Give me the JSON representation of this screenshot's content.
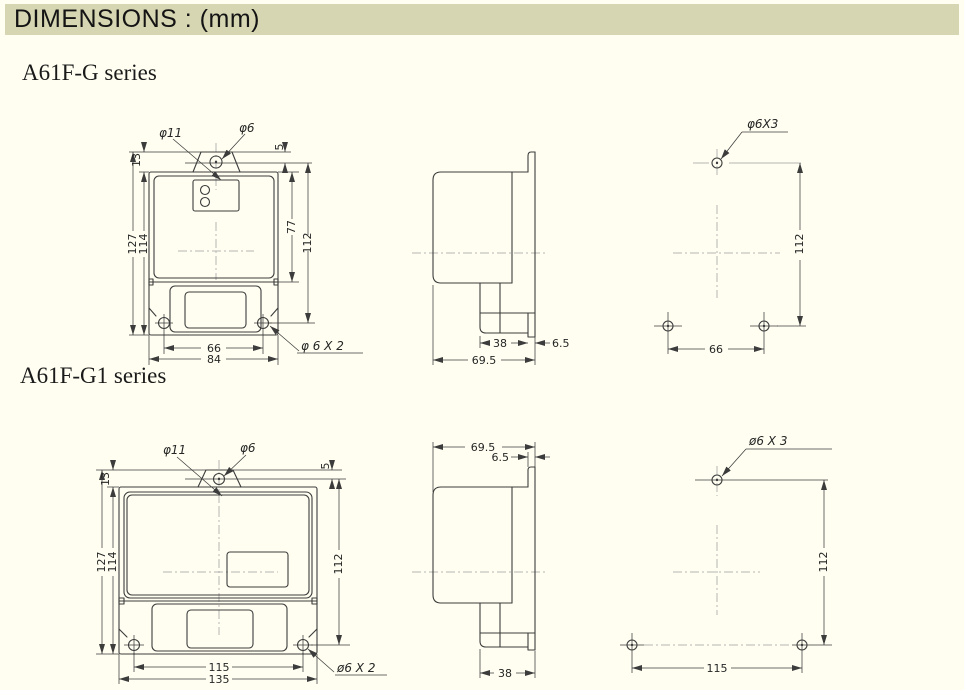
{
  "header": {
    "title": "DIMENSIONS : (mm)"
  },
  "colors": {
    "header_bg": "#d6d6b2",
    "page_bg": "#fffef1",
    "line": "#3c3c3c",
    "centerline": "#b4b4b4"
  },
  "sections": {
    "g": {
      "label": "A61F-G series",
      "front": {
        "phi11": "φ11",
        "phi6": "φ6",
        "dim_13": "13",
        "dim_5": "5",
        "dim_127": "127",
        "dim_114": "114",
        "dim_77": "77",
        "dim_112": "112",
        "dim_66": "66",
        "dim_84": "84",
        "hole_note": "φ 6 X 2"
      },
      "side": {
        "dim_38": "38",
        "dim_6_5": "6.5",
        "dim_69_5": "69.5"
      },
      "holes": {
        "hole_note": "φ6X3",
        "dim_112": "112",
        "dim_66": "66"
      }
    },
    "g1": {
      "label": "A61F-G1 series",
      "front": {
        "phi11": "φ11",
        "phi6": "φ6",
        "dim_13": "13",
        "dim_5": "5",
        "dim_127": "127",
        "dim_114": "114",
        "dim_112": "112",
        "dim_115": "115",
        "dim_135": "135",
        "hole_note": "ø6 X 2"
      },
      "side": {
        "dim_69_5": "69.5",
        "dim_6_5": "6.5",
        "dim_38": "38"
      },
      "holes": {
        "hole_note": "ø6 X 3",
        "dim_112": "112",
        "dim_115": "115"
      }
    }
  }
}
